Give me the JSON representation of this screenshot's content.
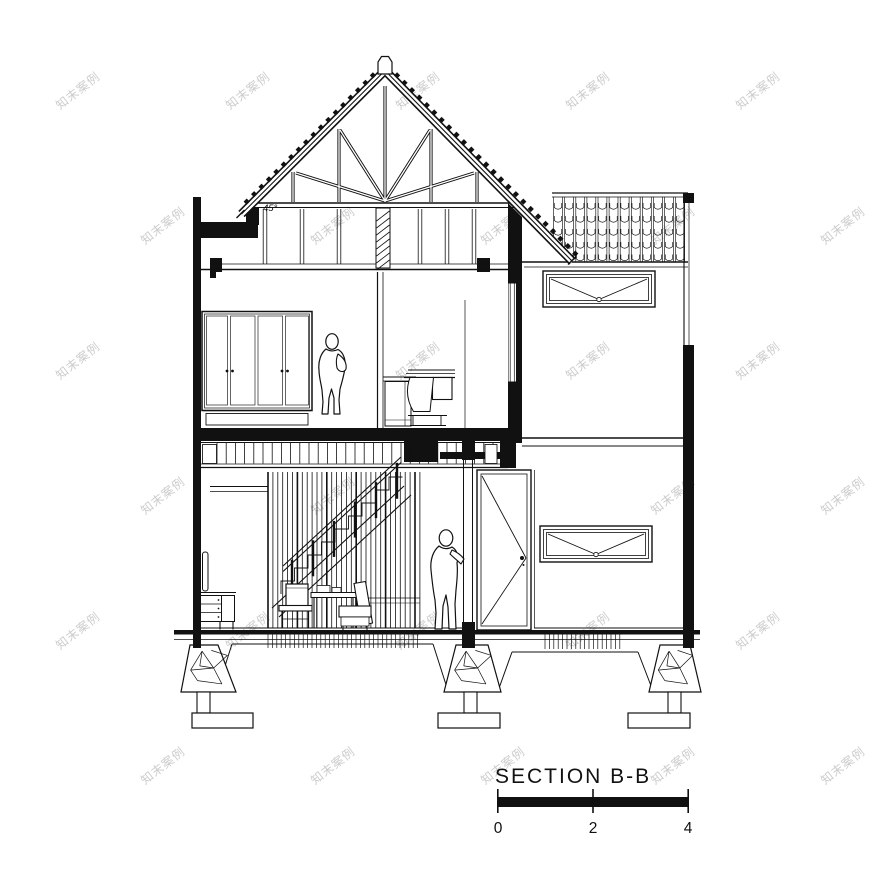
{
  "title": {
    "label": "SECTION B-B"
  },
  "scale_bar": {
    "ticks": [
      "0",
      "2",
      "4"
    ]
  },
  "roof": {
    "angle_label": "45°"
  },
  "watermark": {
    "text": "知末案例"
  },
  "colors": {
    "ink": "#111111",
    "paper": "#ffffff",
    "watermark": "#cccccc"
  }
}
